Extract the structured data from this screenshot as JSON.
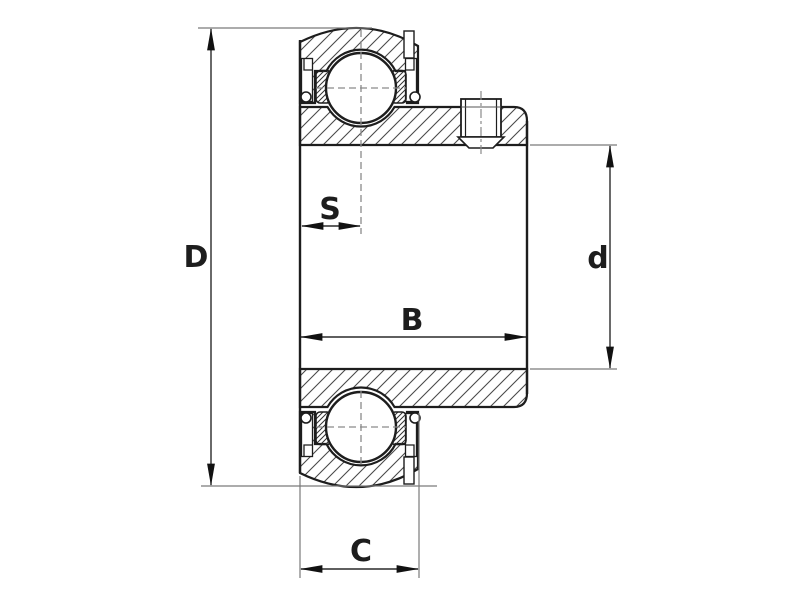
{
  "page": {
    "background": "#ffffff"
  },
  "diagram": {
    "kind": "bearing-cross-section-technical-drawing",
    "labels": {
      "D": "D",
      "S": "S",
      "B": "B",
      "d": "d",
      "C": "C"
    },
    "dimensions": [
      {
        "label": "D",
        "orientation": "vertical",
        "position": "left"
      },
      {
        "label": "S",
        "orientation": "horizontal",
        "position": "upper-middle"
      },
      {
        "label": "B",
        "orientation": "horizontal",
        "position": "middle"
      },
      {
        "label": "d",
        "orientation": "vertical",
        "position": "right"
      },
      {
        "label": "C",
        "orientation": "horizontal",
        "position": "bottom"
      }
    ],
    "colors": {
      "outline": "#1d1d1d",
      "hatch": "#4a4a4a",
      "seal_hatch": "#333333",
      "dimension_line": "#2a2a2a",
      "extension_line": "#7a7a7a",
      "centerline": "#8a8a8a",
      "arrow": "#111111"
    }
  }
}
